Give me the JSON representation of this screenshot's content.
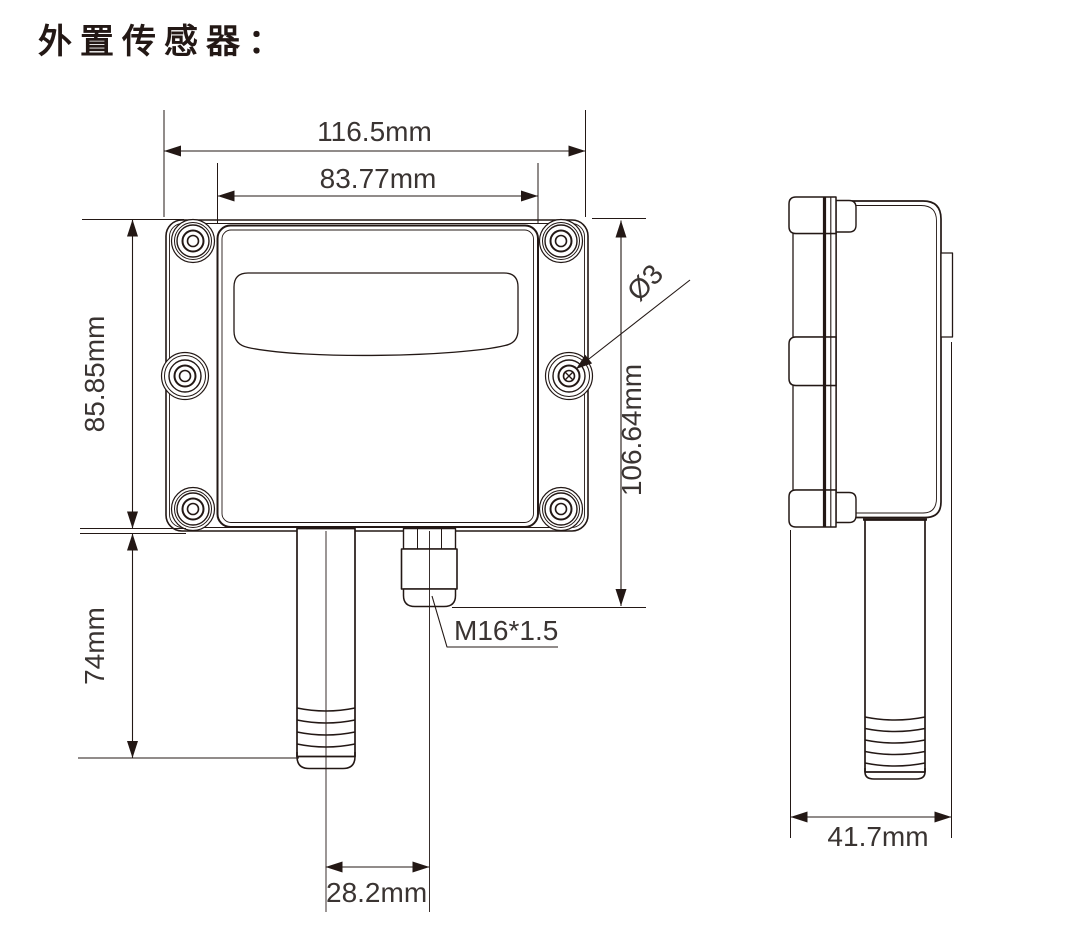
{
  "title": "外置传感器：",
  "dimensions": {
    "front_outer_width": "116.5mm",
    "front_lid_width": "83.77mm",
    "front_body_height": "85.85mm",
    "probe_length": "74mm",
    "front_overall_height": "106.64mm",
    "mount_hole_diameter": "Ø3",
    "cable_gland_thread": "M16*1.5",
    "probe_center_offset": "28.2mm",
    "side_depth": "41.7mm"
  },
  "colors": {
    "line": "#231815",
    "text": "#3a3432",
    "background": "#ffffff"
  }
}
